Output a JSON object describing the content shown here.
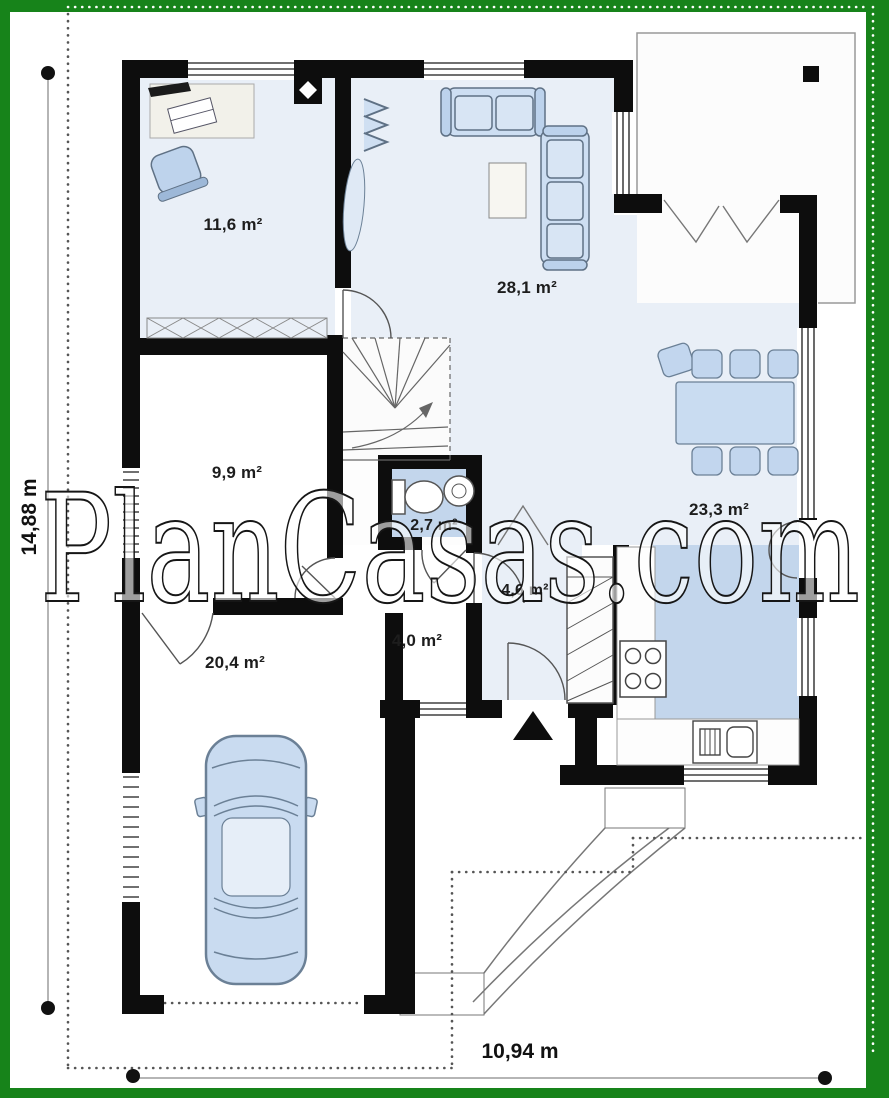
{
  "watermark": "PlanCasas.com",
  "dimensions": {
    "height": "14,88 m",
    "width": "10,94 m"
  },
  "rooms": {
    "study": "11,6 m²",
    "living_room": "28,1 m²",
    "bedroom": "9,9 m²",
    "bathroom": "2,7 m²",
    "kitchen_dining": "23,3 m²",
    "vestibule": "4,6 m²",
    "hall": "4,0 m²",
    "garage": "20,4 m²"
  },
  "colors": {
    "frame_green": "#17831a",
    "floor_light_blue": "#e9eff7",
    "floor_medium_blue": "#c3d6ec",
    "wall_black": "#0d0d0d",
    "furniture_blue": "#c9dcf1"
  }
}
